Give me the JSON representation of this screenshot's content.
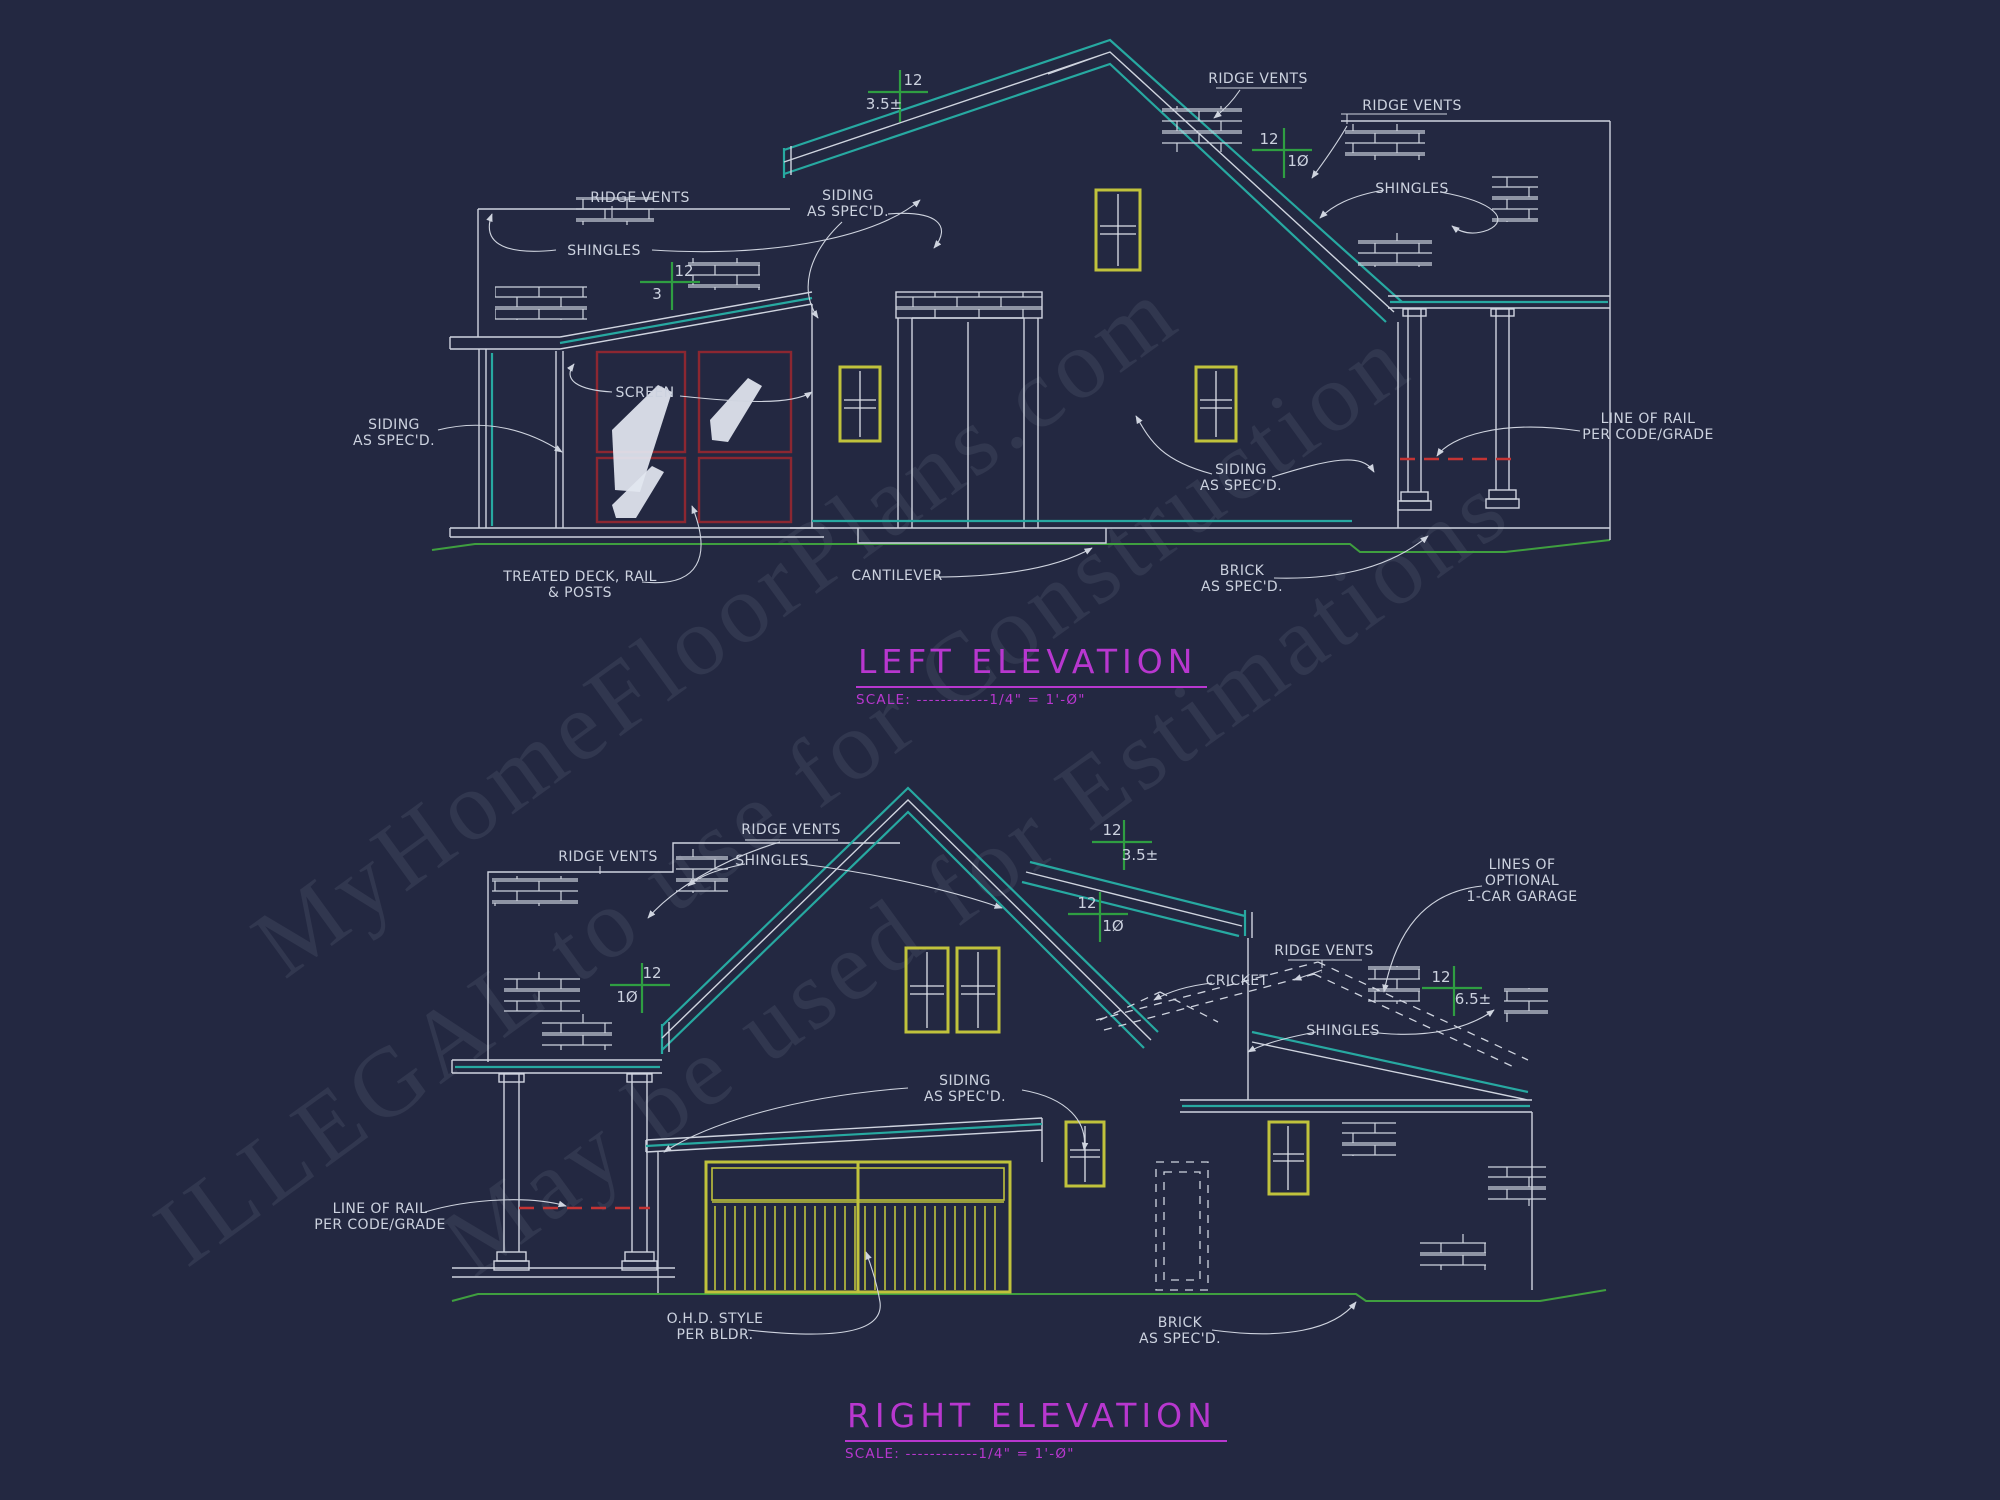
{
  "watermark": {
    "line1": "MyHomeFloorPlans.com",
    "line2": "ILLEGAL to use for Construction",
    "line3": "May be used for Estimations"
  },
  "colors": {
    "background": "#232841",
    "line_white": "#cfd4df",
    "line_teal": "#27a9a1",
    "slope_green": "#2f9e42",
    "ground_green": "#3f9f3f",
    "window_yellow": "#c0c23c",
    "screen_red": "#8c2731",
    "rail_red": "#c43434",
    "title_magenta": "#b837cf"
  },
  "left_elevation": {
    "title": "LEFT ELEVATION",
    "scale": "SCALE: ------------1/4\" = 1'-Ø\"",
    "labels": {
      "ridge_vents_left": "RIDGE VENTS",
      "shingles_left": "SHINGLES",
      "siding_gable": "SIDING\nAS SPEC'D.",
      "siding_left": "SIDING\nAS SPEC'D.",
      "screen": "SCREEN",
      "ridge_vents_top_right": "RIDGE VENTS",
      "ridge_vents_right": "RIDGE VENTS",
      "shingles_right": "SHINGLES",
      "siding_right": "SIDING\nAS SPEC'D.",
      "line_of_rail": "LINE OF RAIL\nPER CODE/GRADE",
      "treated_deck": "TREATED DECK, RAIL\n& POSTS",
      "cantilever": "CANTILEVER",
      "brick": "BRICK\nAS SPEC'D."
    },
    "slopes": {
      "porch": {
        "rise": "12",
        "run": "3"
      },
      "main": {
        "rise": "12",
        "run": "3.5±"
      },
      "right_main": {
        "rise": "12",
        "run": "1Ø"
      }
    }
  },
  "right_elevation": {
    "title": "RIGHT ELEVATION",
    "scale": "SCALE: ------------1/4\" = 1'-Ø\"",
    "labels": {
      "ridge_vents_left": "RIDGE VENTS",
      "ridge_vents_mid": "RIDGE VENTS",
      "shingles_mid": "SHINGLES",
      "lines_of_optional": "LINES OF\nOPTIONAL\n1-CAR GARAGE",
      "ridge_vents_right": "RIDGE VENTS",
      "cricket": "CRICKET",
      "shingles_right": "SHINGLES",
      "siding_mid": "SIDING\nAS SPEC'D.",
      "line_of_rail": "LINE OF RAIL\nPER CODE/GRADE",
      "ohd_style": "O.H.D. STYLE\nPER BLDR.",
      "brick": "BRICK\nAS SPEC'D."
    },
    "slopes": {
      "shed": {
        "rise": "12",
        "run": "3.5±"
      },
      "main_right": {
        "rise": "12",
        "run": "1Ø"
      },
      "main_left": {
        "rise": "12",
        "run": "1Ø"
      },
      "wing": {
        "rise": "12",
        "run": "6.5±"
      }
    }
  }
}
